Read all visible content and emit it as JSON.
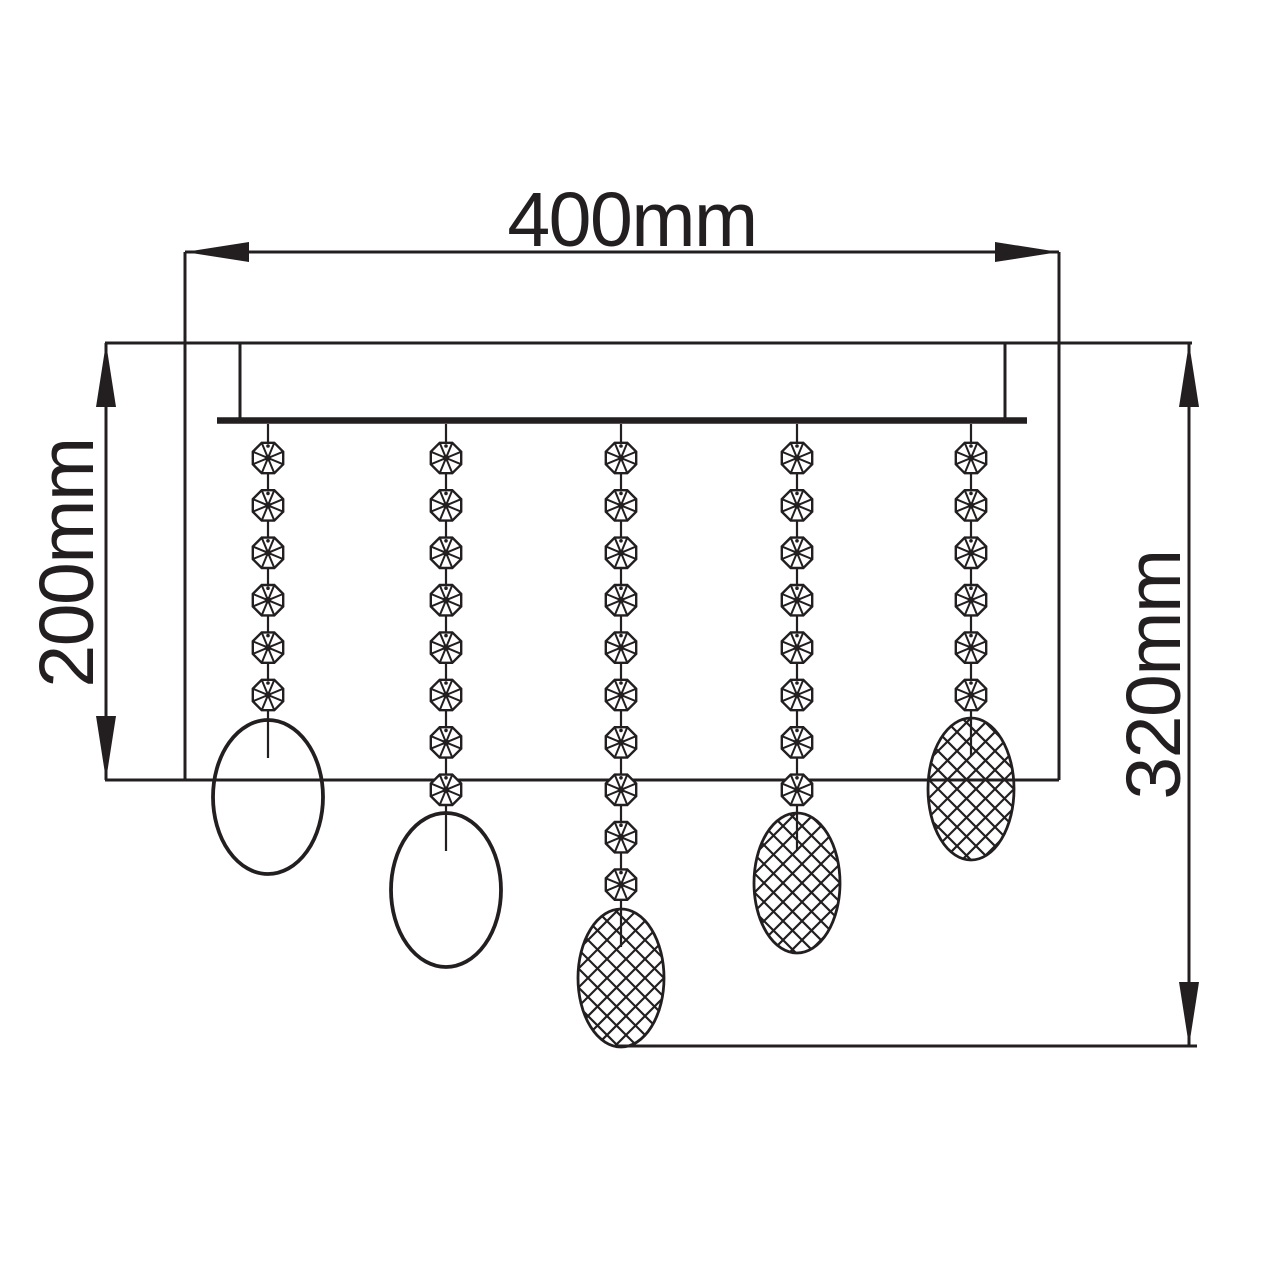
{
  "diagram": {
    "type": "technical-dimension-drawing",
    "subject": "crystal-drop flush ceiling light, front elevation",
    "background": "#ffffff",
    "ink": "#231f20",
    "labels": {
      "width": "400mm",
      "left_height": "200mm",
      "right_height": "320mm"
    },
    "outline": {
      "left": 185,
      "right": 1059,
      "top": 343,
      "bottom": 780,
      "top_ext_left": 105,
      "top_ext_right": 1192,
      "bottom_ext_left": 105
    },
    "canopy": {
      "side_left": 240,
      "side_right": 1005,
      "top": 343,
      "side_bottom": 418,
      "bar_y": 420.5,
      "bar_left": 217,
      "bar_right": 1027,
      "bar_thickness": 6.5
    },
    "dims": {
      "width": {
        "y": 252,
        "x1": 185,
        "x2": 1059
      },
      "left": {
        "x": 106,
        "y1": 343,
        "y2": 780
      },
      "right": {
        "x": 1189,
        "y1": 343,
        "y2": 1046,
        "bottom_ext": {
          "y": 1046,
          "x1": 618,
          "x2": 1197
        }
      }
    },
    "arrow": {
      "length": 64,
      "half_width": 10
    },
    "beads": {
      "first_cy": 458,
      "spacing": 47.4,
      "radius": 16.5,
      "wire_top": 424,
      "stub_depth": 38
    },
    "strands": [
      {
        "x": 268,
        "bead_count": 6,
        "drop": {
          "style": "plain",
          "cy": 797,
          "rx": 55,
          "ry": 77
        }
      },
      {
        "x": 446,
        "bead_count": 8,
        "drop": {
          "style": "plain",
          "cy": 890,
          "rx": 55,
          "ry": 77
        }
      },
      {
        "x": 621,
        "bead_count": 10,
        "drop": {
          "style": "crosshatch",
          "cy": 978,
          "rx": 43,
          "ry": 69
        }
      },
      {
        "x": 797,
        "bead_count": 8,
        "drop": {
          "style": "crosshatch",
          "cy": 883,
          "rx": 43,
          "ry": 70
        }
      },
      {
        "x": 971,
        "bead_count": 6,
        "drop": {
          "style": "crosshatch",
          "cy": 789,
          "rx": 43,
          "ry": 71
        }
      }
    ],
    "hatch": {
      "step": 19,
      "stroke_width": 2.2
    },
    "stroke": {
      "main": 3,
      "wire": 2.2,
      "bead": 2.4,
      "spoke": 2,
      "plain_drop": 3.8,
      "hatch_drop_outline": 2.8
    }
  }
}
